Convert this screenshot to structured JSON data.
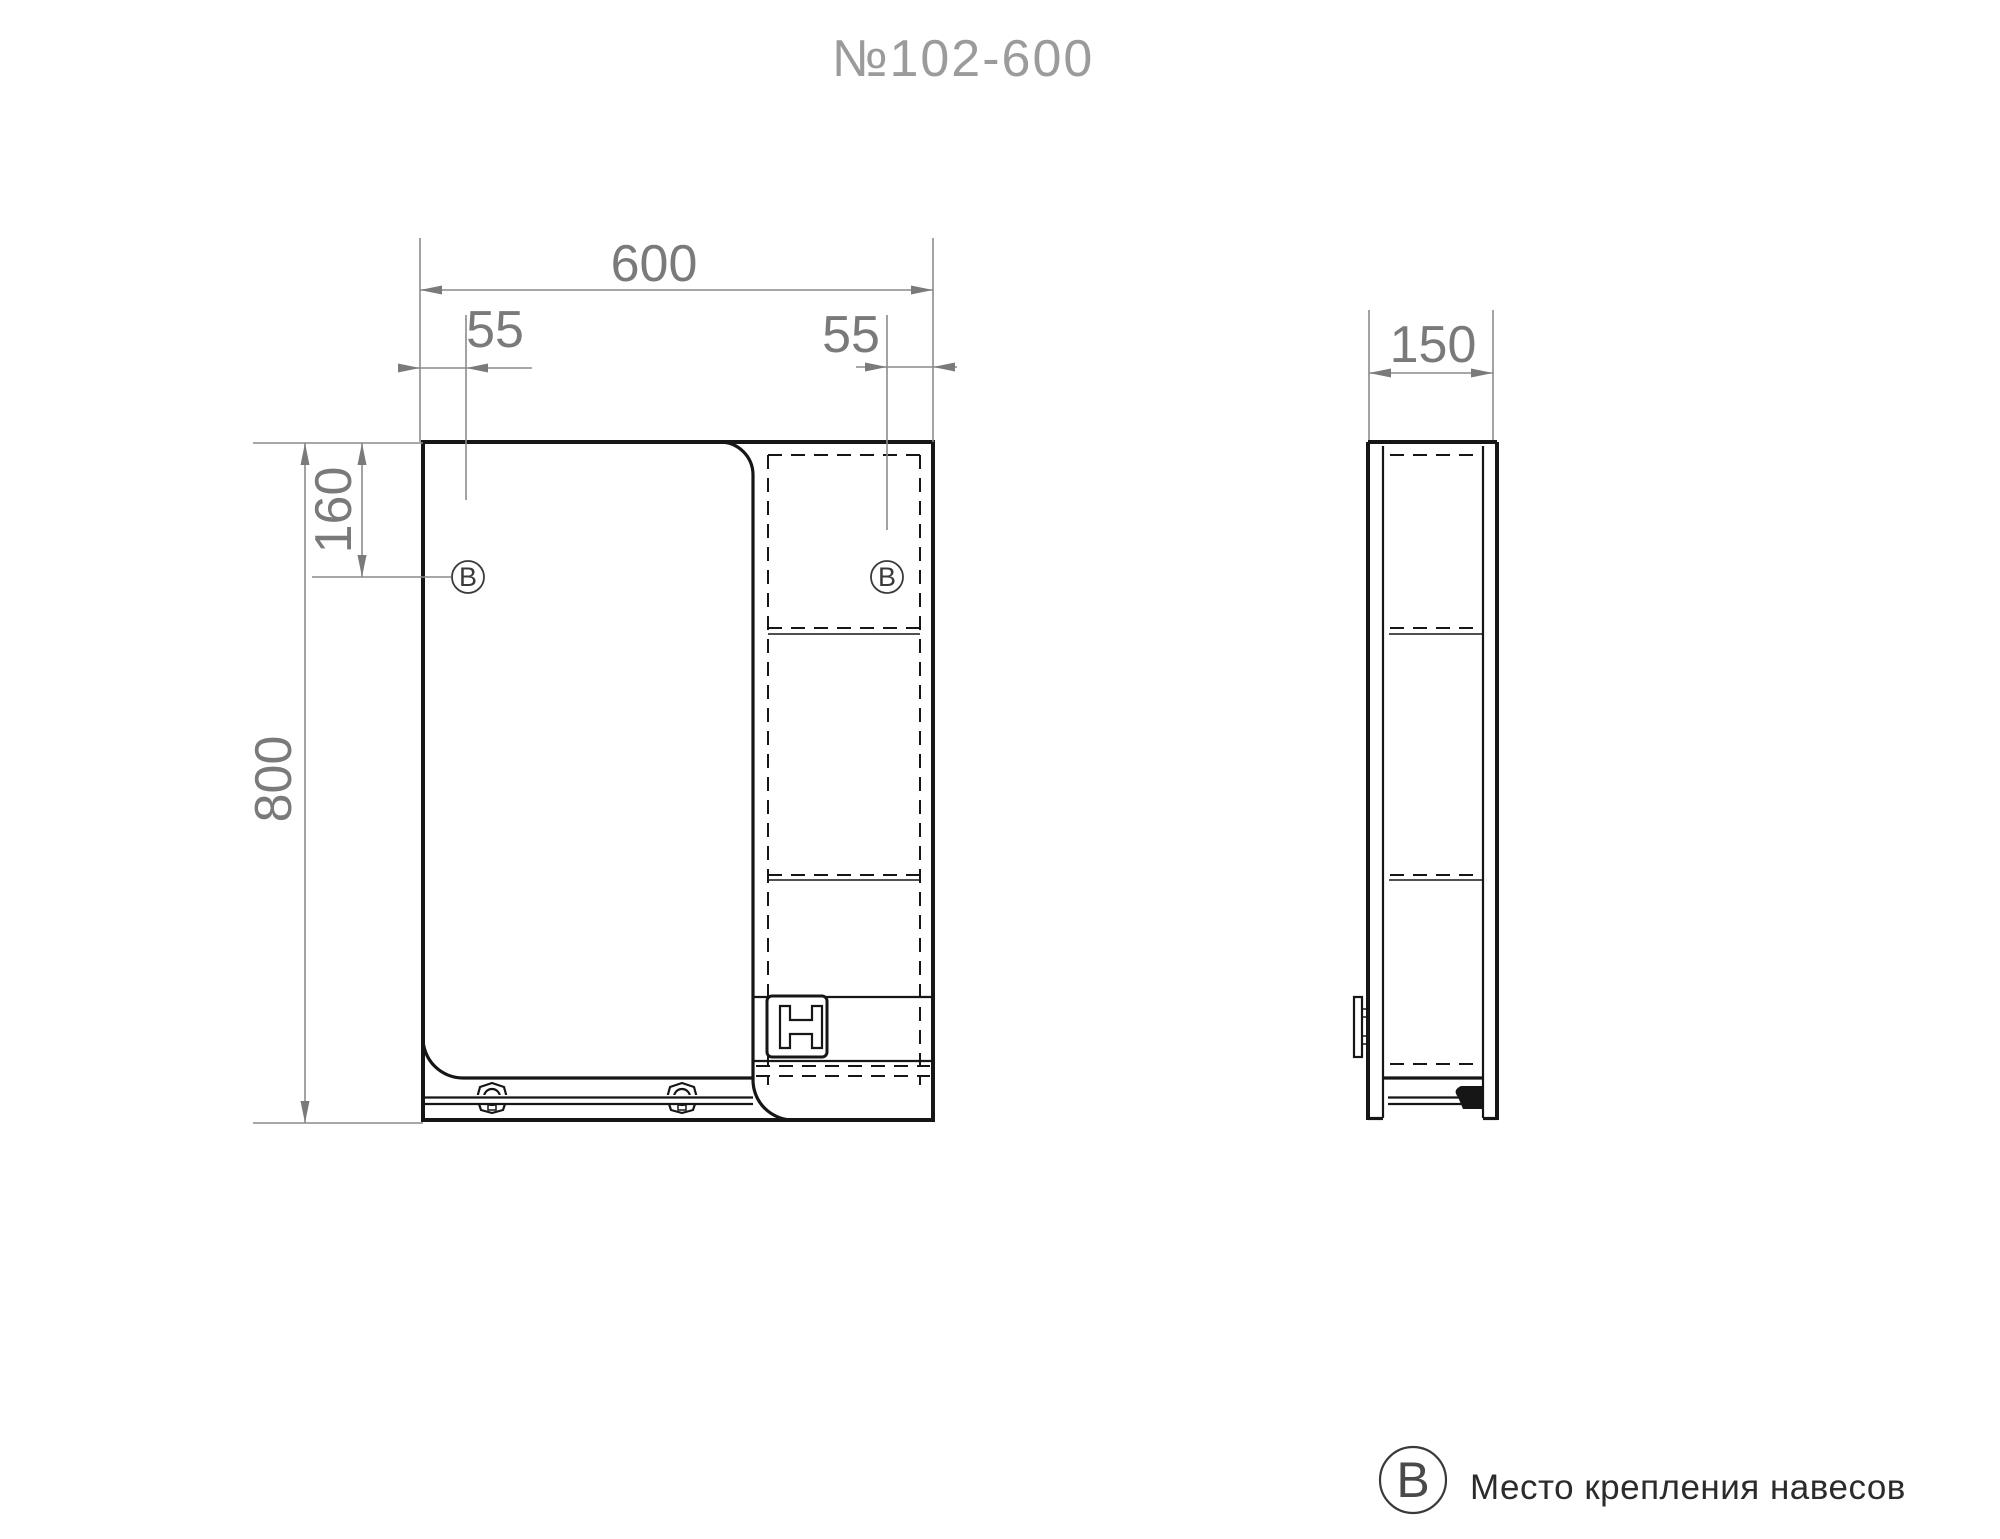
{
  "title": "№102-600",
  "front_view": {
    "name": "front view of mirror cabinet",
    "dim_width": "600",
    "dim_height": "800",
    "dim_offset_left": "55",
    "dim_offset_right": "55",
    "dim_top": "160",
    "marker_left": "В",
    "marker_right": "В"
  },
  "side_view": {
    "name": "side view of mirror cabinet",
    "dim_depth": "150"
  },
  "legend": {
    "symbol": "В",
    "label": "Место крепления навесов"
  },
  "colors": {
    "background": "#ffffff",
    "line": "#161616",
    "dim_line": "#8a8a8a",
    "dim_text": "#7a7a7a",
    "title_text": "#9b9b9b",
    "legend_text": "#2b2b2b",
    "marker": "#3a3a3a"
  }
}
